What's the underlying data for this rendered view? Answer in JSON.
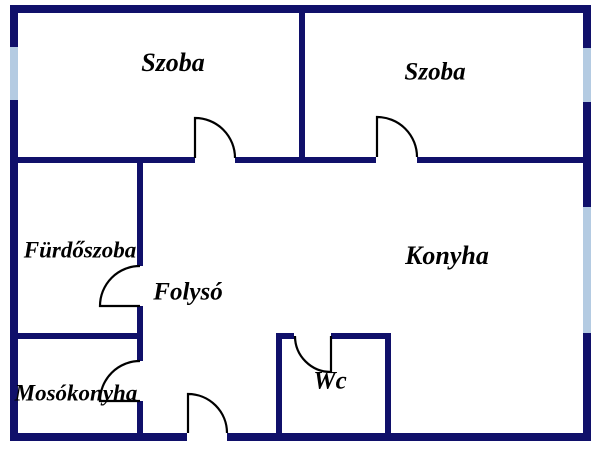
{
  "plan": {
    "type": "floor-plan",
    "rooms": {
      "szoba_left": {
        "label": "Szoba"
      },
      "szoba_right": {
        "label": "Szoba"
      },
      "furdoszoba": {
        "label": "Fürdőszoba"
      },
      "folyso": {
        "label": "Folysó"
      },
      "konyha": {
        "label": "Konyha"
      },
      "mosokonyha": {
        "label": "Mosókonyha"
      },
      "wc": {
        "label": "Wc"
      }
    },
    "doors": [
      "szoba-left-door",
      "szoba-right-door",
      "furdoszoba-door",
      "mosokonyha-door",
      "entrance-door",
      "wc-door"
    ],
    "windows": [
      "left-wall-window",
      "right-wall-upper-window",
      "right-wall-lower-window"
    ]
  },
  "colors": {
    "wall": "#10106a",
    "window": "#b4cbe2",
    "door": "#000000",
    "label": "#000000",
    "background": "#ffffff"
  }
}
